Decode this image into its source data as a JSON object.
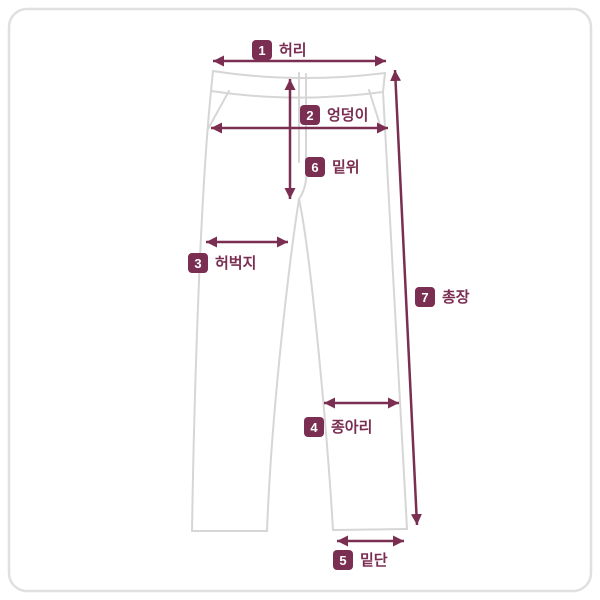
{
  "colors": {
    "accent": "#7a2e51",
    "pants_outline": "#d6d6d6",
    "panel_border": "#e0e0e0",
    "background": "#ffffff",
    "label_number_text": "#ffffff"
  },
  "diagram": {
    "subject": "pants-size-measurement-guide",
    "measurements": [
      {
        "num": "1",
        "text": "허리"
      },
      {
        "num": "2",
        "text": "엉덩이"
      },
      {
        "num": "3",
        "text": "허벅지"
      },
      {
        "num": "4",
        "text": "종아리"
      },
      {
        "num": "5",
        "text": "밑단"
      },
      {
        "num": "6",
        "text": "밑위"
      },
      {
        "num": "7",
        "text": "총장"
      }
    ]
  }
}
